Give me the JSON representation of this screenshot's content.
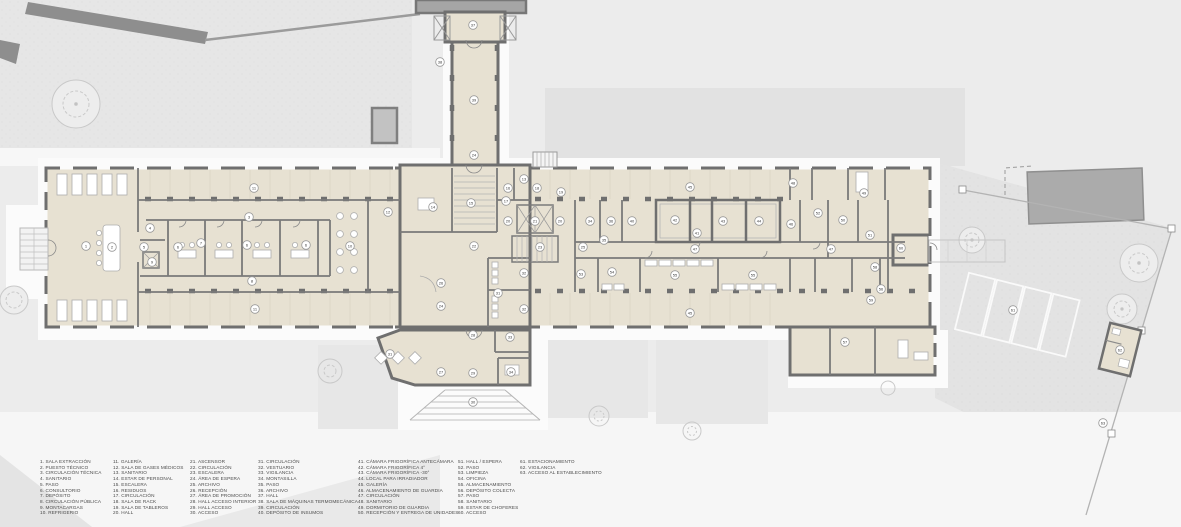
{
  "colors": {
    "site_bg": "#ececec",
    "floor": "#e7e1d2",
    "wall": "#6f6f6f",
    "neighbor_building": "#a5a5a5",
    "marker_fill": "#ffffff",
    "marker_stroke": "#999999",
    "legend_text": "#4a4a4a"
  },
  "legend": {
    "columns": [
      [
        {
          "n": "1",
          "label": "SALA EXTRACCIÓN"
        },
        {
          "n": "2",
          "label": "PUESTO TÉCNICO"
        },
        {
          "n": "3",
          "label": "CIRCULACIÓN TÉCNICA"
        },
        {
          "n": "4",
          "label": "SANITARIO"
        },
        {
          "n": "5",
          "label": "PASO"
        },
        {
          "n": "6",
          "label": "CONSULTORIO"
        },
        {
          "n": "7",
          "label": "DEPÓSITO"
        },
        {
          "n": "8",
          "label": "CIRCULACIÓN PÚBLICA"
        },
        {
          "n": "9",
          "label": "MONTACARGAS"
        },
        {
          "n": "10",
          "label": "REFRIGERIO"
        }
      ],
      [
        {
          "n": "11",
          "label": "GALERÍA"
        },
        {
          "n": "12",
          "label": "SALA DE GASES MÉDICOS"
        },
        {
          "n": "13",
          "label": "SANITARIO"
        },
        {
          "n": "14",
          "label": "ESTAR DE PERSONAL"
        },
        {
          "n": "15",
          "label": "ESCALERA"
        },
        {
          "n": "16",
          "label": "RESIDUOS"
        },
        {
          "n": "17",
          "label": "CIRCULACIÓN"
        },
        {
          "n": "18",
          "label": "SALA DE RACK"
        },
        {
          "n": "19",
          "label": "SALA DE TABLEROS"
        },
        {
          "n": "20",
          "label": "HALL"
        }
      ],
      [
        {
          "n": "21",
          "label": "ASCENSOR"
        },
        {
          "n": "22",
          "label": "CIRCULACIÓN"
        },
        {
          "n": "23",
          "label": "ESCALERA"
        },
        {
          "n": "24",
          "label": "ÁREA DE ESPERA"
        },
        {
          "n": "25",
          "label": "ARCHIVO"
        },
        {
          "n": "26",
          "label": "RECEPCIÓN"
        },
        {
          "n": "27",
          "label": "ÁREA DE PROMOCIÓN"
        },
        {
          "n": "28",
          "label": "HALL ACCESO INTERIOR"
        },
        {
          "n": "29",
          "label": "HALL ACCESO"
        },
        {
          "n": "30",
          "label": "ACCESO"
        }
      ],
      [
        {
          "n": "31",
          "label": "CIRCULACIÓN"
        },
        {
          "n": "32",
          "label": "VESTUARIO"
        },
        {
          "n": "33",
          "label": "VIGILANCIA"
        },
        {
          "n": "34",
          "label": "MONTASILLA"
        },
        {
          "n": "35",
          "label": "PASO"
        },
        {
          "n": "36",
          "label": "ARCHIVO"
        },
        {
          "n": "37",
          "label": "HALL"
        },
        {
          "n": "38",
          "label": "SALA DE MÁQUINAS TERMOMECÁNICA"
        },
        {
          "n": "39",
          "label": "CIRCULACIÓN"
        },
        {
          "n": "40",
          "label": "DEPÓSITO DE INSUMOS"
        }
      ],
      [
        {
          "n": "41",
          "label": "CÁMARA FRIGORÍFICA ANTECÁMARA"
        },
        {
          "n": "42",
          "label": "CÁMARA FRIGORÍFICA 4°"
        },
        {
          "n": "43",
          "label": "CÁMARA FRIGORÍFICA -30°"
        },
        {
          "n": "44",
          "label": "LOCAL PARA IRRADIADOR"
        },
        {
          "n": "45",
          "label": "GALERÍA"
        },
        {
          "n": "46",
          "label": "ALMACENAMIENTO DE GUARDIA"
        },
        {
          "n": "47",
          "label": "CIRCULACIÓN"
        },
        {
          "n": "48",
          "label": "SANITARIO"
        },
        {
          "n": "49",
          "label": "DORMITORIO DE GUARDIA"
        },
        {
          "n": "50",
          "label": "RECEPCIÓN Y ENTREGA DE UNIDADES"
        }
      ],
      [
        {
          "n": "51",
          "label": "HALL / ESPERA"
        },
        {
          "n": "52",
          "label": "PASO"
        },
        {
          "n": "53",
          "label": "LIMPIEZA"
        },
        {
          "n": "54",
          "label": "OFICINA"
        },
        {
          "n": "55",
          "label": "ALMACENAMIENTO"
        },
        {
          "n": "56",
          "label": "DEPÓSITO COLECTA"
        },
        {
          "n": "57",
          "label": "PASO"
        },
        {
          "n": "58",
          "label": "SANITARIO"
        },
        {
          "n": "59",
          "label": "ESTAR DE CHOFERES"
        },
        {
          "n": "60",
          "label": "ACCESO"
        }
      ],
      [
        {
          "n": "61",
          "label": "ESTACIONAMIENTO"
        },
        {
          "n": "62",
          "label": "VIGILANCIA"
        },
        {
          "n": "63",
          "label": "ACCESO AL ESTABLECIMIENTO"
        }
      ]
    ]
  },
  "plan": {
    "room_markers": [
      {
        "n": "1",
        "x": 86,
        "y": 246
      },
      {
        "n": "2",
        "x": 112,
        "y": 247
      },
      {
        "n": "3",
        "x": 249,
        "y": 217
      },
      {
        "n": "4",
        "x": 150,
        "y": 228
      },
      {
        "n": "5",
        "x": 144,
        "y": 247
      },
      {
        "n": "9",
        "x": 152,
        "y": 262
      },
      {
        "n": "6",
        "x": 178,
        "y": 247
      },
      {
        "n": "6",
        "x": 247,
        "y": 245
      },
      {
        "n": "6",
        "x": 306,
        "y": 245
      },
      {
        "n": "7",
        "x": 201,
        "y": 243
      },
      {
        "n": "8",
        "x": 252,
        "y": 281
      },
      {
        "n": "10",
        "x": 350,
        "y": 246
      },
      {
        "n": "11",
        "x": 254,
        "y": 188
      },
      {
        "n": "11",
        "x": 255,
        "y": 309
      },
      {
        "n": "12",
        "x": 388,
        "y": 212
      },
      {
        "n": "13",
        "x": 524,
        "y": 179
      },
      {
        "n": "14",
        "x": 433,
        "y": 207
      },
      {
        "n": "15",
        "x": 471,
        "y": 203
      },
      {
        "n": "16",
        "x": 508,
        "y": 188
      },
      {
        "n": "17",
        "x": 506,
        "y": 201
      },
      {
        "n": "18",
        "x": 537,
        "y": 188
      },
      {
        "n": "19",
        "x": 561,
        "y": 192
      },
      {
        "n": "20",
        "x": 508,
        "y": 221
      },
      {
        "n": "21",
        "x": 535,
        "y": 221
      },
      {
        "n": "20",
        "x": 560,
        "y": 221
      },
      {
        "n": "22",
        "x": 474,
        "y": 246
      },
      {
        "n": "23",
        "x": 540,
        "y": 247
      },
      {
        "n": "24",
        "x": 474,
        "y": 155
      },
      {
        "n": "24",
        "x": 441,
        "y": 306
      },
      {
        "n": "25",
        "x": 583,
        "y": 247
      },
      {
        "n": "26",
        "x": 441,
        "y": 283
      },
      {
        "n": "27",
        "x": 441,
        "y": 372
      },
      {
        "n": "28",
        "x": 473,
        "y": 335
      },
      {
        "n": "29",
        "x": 473,
        "y": 373
      },
      {
        "n": "30",
        "x": 473,
        "y": 402
      },
      {
        "n": "31",
        "x": 390,
        "y": 354
      },
      {
        "n": "31",
        "x": 498,
        "y": 293
      },
      {
        "n": "32",
        "x": 524,
        "y": 273
      },
      {
        "n": "32",
        "x": 524,
        "y": 309
      },
      {
        "n": "33",
        "x": 510,
        "y": 337
      },
      {
        "n": "34",
        "x": 511,
        "y": 372
      },
      {
        "n": "34",
        "x": 590,
        "y": 221
      },
      {
        "n": "35",
        "x": 604,
        "y": 240
      },
      {
        "n": "36",
        "x": 611,
        "y": 221
      },
      {
        "n": "37",
        "x": 473,
        "y": 25
      },
      {
        "n": "38",
        "x": 440,
        "y": 62
      },
      {
        "n": "39",
        "x": 474,
        "y": 100
      },
      {
        "n": "40",
        "x": 632,
        "y": 221
      },
      {
        "n": "41",
        "x": 697,
        "y": 233
      },
      {
        "n": "42",
        "x": 675,
        "y": 220
      },
      {
        "n": "43",
        "x": 723,
        "y": 221
      },
      {
        "n": "44",
        "x": 759,
        "y": 221
      },
      {
        "n": "45",
        "x": 690,
        "y": 187
      },
      {
        "n": "45",
        "x": 690,
        "y": 313
      },
      {
        "n": "46",
        "x": 791,
        "y": 224
      },
      {
        "n": "47",
        "x": 695,
        "y": 249
      },
      {
        "n": "47",
        "x": 831,
        "y": 249
      },
      {
        "n": "48",
        "x": 793,
        "y": 183
      },
      {
        "n": "49",
        "x": 864,
        "y": 193
      },
      {
        "n": "50",
        "x": 843,
        "y": 220
      },
      {
        "n": "51",
        "x": 870,
        "y": 235
      },
      {
        "n": "52",
        "x": 818,
        "y": 213
      },
      {
        "n": "53",
        "x": 581,
        "y": 274
      },
      {
        "n": "54",
        "x": 612,
        "y": 272
      },
      {
        "n": "55",
        "x": 675,
        "y": 275
      },
      {
        "n": "55",
        "x": 753,
        "y": 275
      },
      {
        "n": "56",
        "x": 881,
        "y": 289
      },
      {
        "n": "57",
        "x": 845,
        "y": 342
      },
      {
        "n": "58",
        "x": 875,
        "y": 267
      },
      {
        "n": "59",
        "x": 871,
        "y": 300
      },
      {
        "n": "60",
        "x": 901,
        "y": 248
      },
      {
        "n": "61",
        "x": 1013,
        "y": 310
      },
      {
        "n": "62",
        "x": 1120,
        "y": 350
      },
      {
        "n": "63",
        "x": 1103,
        "y": 423
      }
    ]
  }
}
